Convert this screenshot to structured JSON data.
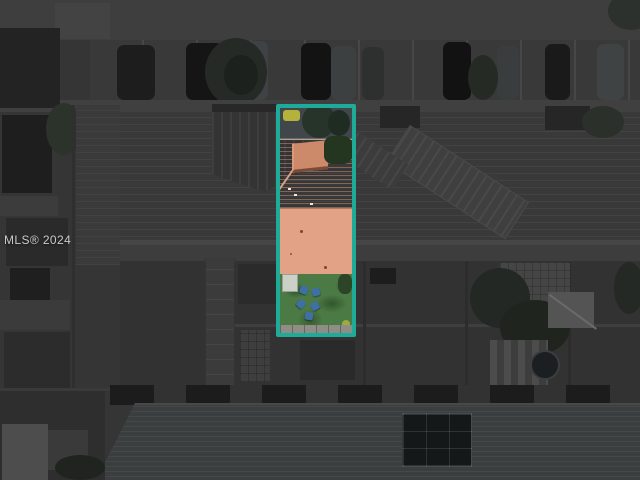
{
  "photo": {
    "watermark": "MLS® 2024",
    "colors": {
      "highlight_border": "#1FAB9A",
      "roof_tile": "#B5684F",
      "roof_flat": "#E2A285",
      "lawn": "#4C7A45",
      "dimmed_background": "#353535"
    }
  }
}
